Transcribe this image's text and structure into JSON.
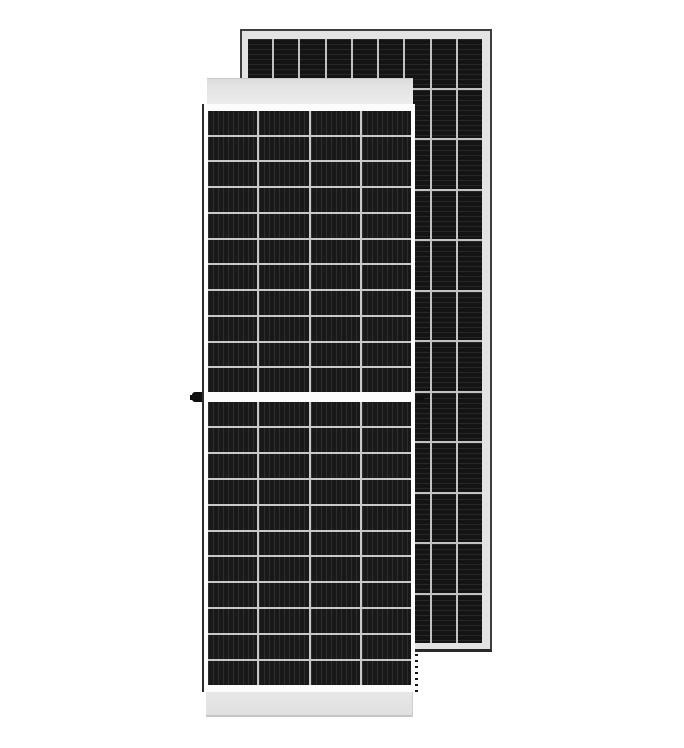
{
  "scene": {
    "description": "Product photo of two framed monocrystalline half-cut solar panels on a white background; front panel faces the viewer, a second taller panel stands behind and to the right.",
    "background_color": "#ffffff"
  },
  "back_panel": {
    "label": "rear solar panel",
    "rows": 12,
    "columns": 9,
    "stripe_direction": "horizontal",
    "frame_color": "#e3e3e3",
    "edge_color": "#3d3d3d",
    "edge_bottom_color": "#262626",
    "cell_color": "#141414",
    "stripe_color": "#272727",
    "divider_color": "#c2c2c2"
  },
  "front_panel": {
    "label": "front solar panel",
    "columns": 4,
    "rows_upper": 11,
    "rows_lower": 11,
    "stripe_direction": "vertical",
    "backing_color": "#fcfcfc",
    "top_rail_color": "#e4e4e4",
    "bottom_rail_color": "#e0e0e0",
    "frame_edge_color": "#2d2d2d",
    "cell_color": "#191919",
    "stripe_color": "#2e2e2e",
    "divider_color": "#c8c8c8",
    "mounting_knob_color": "#0f0f0f"
  }
}
